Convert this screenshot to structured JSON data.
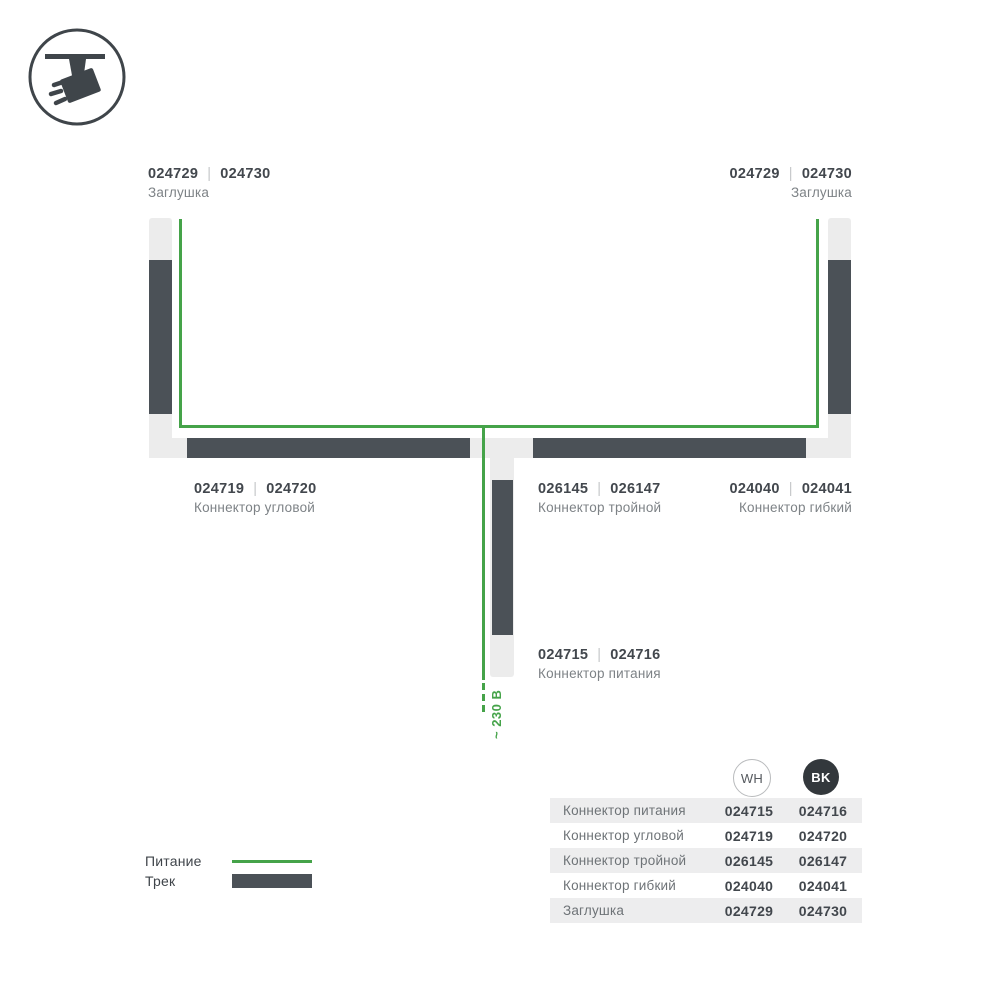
{
  "colors": {
    "power_green": "#45a349",
    "track_dark": "#4b5157",
    "housing_light": "#ececec",
    "number_text": "#42474d",
    "name_text": "#7d8286",
    "table_stripe": "#ededee",
    "bk_badge": "#33383c"
  },
  "diagram": {
    "separator": "|",
    "voltage_label": "~ 230 В",
    "labels": {
      "endcap_left": {
        "wh": "024729",
        "bk": "024730",
        "name": "Заглушка"
      },
      "endcap_right": {
        "wh": "024729",
        "bk": "024730",
        "name": "Заглушка"
      },
      "corner": {
        "wh": "024719",
        "bk": "024720",
        "name": "Коннектор угловой"
      },
      "triple": {
        "wh": "026145",
        "bk": "026147",
        "name": "Коннектор тройной"
      },
      "flexible": {
        "wh": "024040",
        "bk": "024041",
        "name": "Коннектор гибкий"
      },
      "power": {
        "wh": "024715",
        "bk": "024716",
        "name": "Коннектор питания"
      }
    }
  },
  "legend": {
    "power": "Питание",
    "track": "Трек"
  },
  "table": {
    "columns": {
      "wh": "WH",
      "bk": "BK"
    },
    "rows": [
      {
        "name": "Коннектор питания",
        "wh": "024715",
        "bk": "024716"
      },
      {
        "name": "Коннектор угловой",
        "wh": "024719",
        "bk": "024720"
      },
      {
        "name": "Коннектор тройной",
        "wh": "026145",
        "bk": "026147"
      },
      {
        "name": "Коннектор гибкий",
        "wh": "024040",
        "bk": "024041"
      },
      {
        "name": "Заглушка",
        "wh": "024729",
        "bk": "024730"
      }
    ]
  }
}
